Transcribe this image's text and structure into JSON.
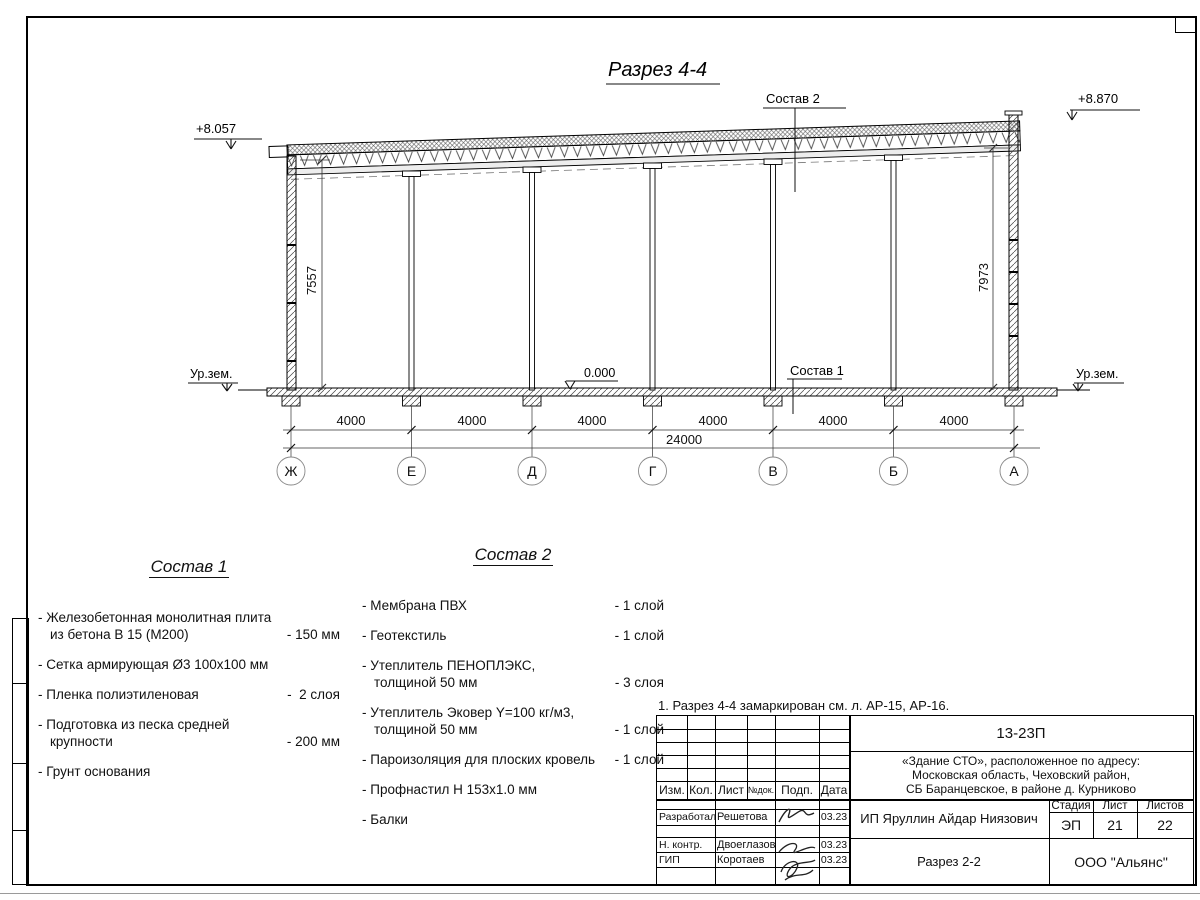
{
  "drawing": {
    "title": "Разрез 4-4",
    "elevation_left": "+8.057",
    "elevation_right": "+8.870",
    "elevation_zero": "0.000",
    "ground_left": "Ур.зем.",
    "ground_right": "Ур.зем.",
    "leader_roof": "Состав 2",
    "leader_floor": "Состав 1",
    "height_left": "7557",
    "height_right": "7973",
    "axes": [
      "Ж",
      "Е",
      "Д",
      "Г",
      "В",
      "Б",
      "А"
    ],
    "bays": [
      "4000",
      "4000",
      "4000",
      "4000",
      "4000",
      "4000"
    ],
    "total": "24000"
  },
  "sostav1": {
    "title": "Состав 1",
    "items": [
      {
        "name": "- Железобетонная  монолитная плита\nиз бетона В 15 (М200)",
        "qty": "- 150 мм"
      },
      {
        "name": "- Сетка армирующая Ø3 100х100 мм",
        "qty": ""
      },
      {
        "name": "- Пленка полиэтиленовая",
        "qty": "-  2 слоя"
      },
      {
        "name": "- Подготовка из песка средней\nкрупности",
        "qty": "- 200 мм"
      },
      {
        "name": "- Грунт основания",
        "qty": ""
      }
    ]
  },
  "sostav2": {
    "title": "Состав 2",
    "items": [
      {
        "name": "- Мембрана ПВХ",
        "qty": "- 1 слой"
      },
      {
        "name": "- Геотекстиль",
        "qty": "- 1 слой"
      },
      {
        "name": "- Утеплитель ПЕНОПЛЭКС,\nтолщиной 50 мм",
        "qty": "- 3 слоя"
      },
      {
        "name": "- Утеплитель Эковер Y=100 кг/м3,\nтолщиной 50 мм",
        "qty": "- 1 слой"
      },
      {
        "name": "- Пароизоляция для плоских кровель",
        "qty": "- 1 слой"
      },
      {
        "name": "- Профнастил Н 153х1.0 мм",
        "qty": ""
      },
      {
        "name": "- Балки",
        "qty": ""
      }
    ]
  },
  "note": "1. Разрез 4-4 замаркирован см. л. АР-15, АР-16.",
  "titleblock": {
    "code": "13-23П",
    "object": "«Здание СТО», расположенное по адресу:\nМосковская область, Чеховский район,\nСБ Баранцевское, в районе д. Курниково",
    "col_izm": "Изм.",
    "col_kol": "Кол.",
    "col_list": "Лист",
    "col_ndok": "№док.",
    "col_podp": "Подп.",
    "col_data": "Дата",
    "rows": [
      {
        "role": "Разработал",
        "name": "Решетова",
        "date": "03.23"
      },
      {
        "role": "Н. контр.",
        "name": "Двоеглазов",
        "date": "03.23"
      },
      {
        "role": "ГИП",
        "name": "Коротаев",
        "date": "03.23"
      }
    ],
    "designer": "ИП Яруллин Айдар Ниязович",
    "stage_label": "Стадия",
    "sheet_label": "Лист",
    "sheets_label": "Листов",
    "stage": "ЭП",
    "sheet": "21",
    "sheets": "22",
    "doc_name": "Разрез 2-2",
    "company": "ООО \"Альянс\""
  }
}
